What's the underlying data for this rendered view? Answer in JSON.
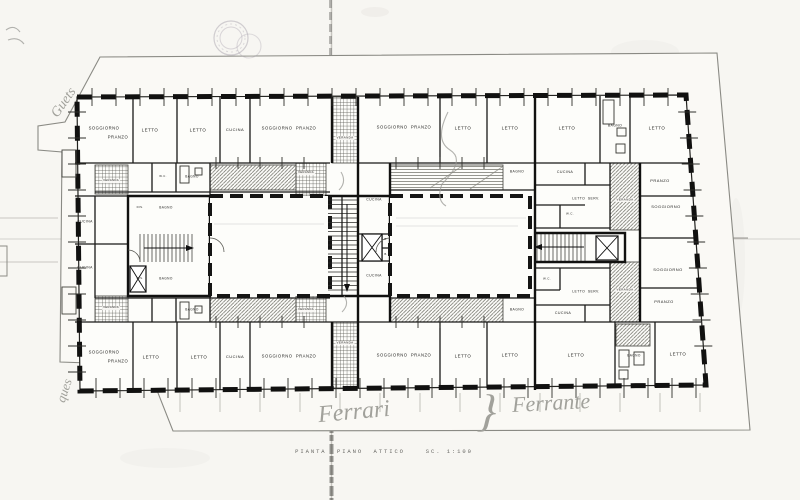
{
  "sheet": {
    "caption": "PIANTA  PIANO  ATTICO    SC. 1:100",
    "paper_color": "#f7f6f2",
    "ink_color": "#1b1b19",
    "pencil_color": "#a1a19b",
    "stamp_color": "#aaa3ae"
  },
  "rooms": [
    {
      "label": "SOGGIORNO",
      "x": 104,
      "y": 128,
      "fs": 4.2
    },
    {
      "label": "PRANZO",
      "x": 118,
      "y": 137,
      "fs": 4.2
    },
    {
      "label": "LETTO",
      "x": 150,
      "y": 130
    },
    {
      "label": "LETTO",
      "x": 198,
      "y": 130
    },
    {
      "label": "CUCINA",
      "x": 235,
      "y": 130,
      "fs": 4
    },
    {
      "label": "SOGGIORNO  PRANZO",
      "x": 289,
      "y": 128,
      "fs": 4.2
    },
    {
      "label": "VERANDA",
      "x": 345,
      "y": 138,
      "fs": 3,
      "bg": true
    },
    {
      "label": "SOGGIORNO  PRANZO",
      "x": 404,
      "y": 127,
      "fs": 4.2
    },
    {
      "label": "LETTO",
      "x": 463,
      "y": 128
    },
    {
      "label": "LETTO",
      "x": 510,
      "y": 128
    },
    {
      "label": "LETTO",
      "x": 567,
      "y": 128
    },
    {
      "label": "BAGNO",
      "x": 615,
      "y": 126,
      "fs": 3.4
    },
    {
      "label": "LETTO",
      "x": 657,
      "y": 128
    },
    {
      "label": "CUCINA",
      "x": 565,
      "y": 172,
      "fs": 3.6
    },
    {
      "label": "PRANZO",
      "x": 660,
      "y": 181,
      "fs": 4
    },
    {
      "label": "LETTO  SERV.",
      "x": 586,
      "y": 199,
      "fs": 3.4
    },
    {
      "label": "VERANDA",
      "x": 625,
      "y": 200,
      "fs": 3,
      "bg": true
    },
    {
      "label": "SOGGIORNO",
      "x": 666,
      "y": 207,
      "fs": 4
    },
    {
      "label": "W.C.",
      "x": 570,
      "y": 214,
      "fs": 3
    },
    {
      "label": "CUCINA",
      "x": 85,
      "y": 222,
      "fs": 3.4
    },
    {
      "label": "CUCINA",
      "x": 85,
      "y": 268,
      "fs": 3.4
    },
    {
      "label": "VERANDA",
      "x": 111,
      "y": 181,
      "fs": 2.8,
      "bg": true
    },
    {
      "label": "W.C.",
      "x": 163,
      "y": 177,
      "fs": 2.8
    },
    {
      "label": "BAGNO",
      "x": 192,
      "y": 177,
      "fs": 3.2
    },
    {
      "label": "DIS.",
      "x": 140,
      "y": 208,
      "fs": 2.8
    },
    {
      "label": "BAGNO",
      "x": 166,
      "y": 208,
      "fs": 3.2
    },
    {
      "label": "DIS.",
      "x": 140,
      "y": 279,
      "fs": 2.8
    },
    {
      "label": "BAGNO",
      "x": 166,
      "y": 279,
      "fs": 3.2
    },
    {
      "label": "VERANDA",
      "x": 111,
      "y": 308,
      "fs": 2.8,
      "bg": true
    },
    {
      "label": "BAGNO",
      "x": 192,
      "y": 310,
      "fs": 3.2
    },
    {
      "label": "VERANDA",
      "x": 306,
      "y": 173,
      "fs": 2.8,
      "bg": true
    },
    {
      "label": "CUCINA",
      "x": 374,
      "y": 200,
      "fs": 3.4
    },
    {
      "label": "B.",
      "x": 386,
      "y": 240,
      "fs": 2.8
    },
    {
      "label": "B.",
      "x": 386,
      "y": 255,
      "fs": 2.8
    },
    {
      "label": "CUCINA",
      "x": 374,
      "y": 276,
      "fs": 3.4
    },
    {
      "label": "VERANDA",
      "x": 306,
      "y": 310,
      "fs": 2.8,
      "bg": true
    },
    {
      "label": "BAGNO",
      "x": 517,
      "y": 172,
      "fs": 3.4
    },
    {
      "label": "BAGNO",
      "x": 517,
      "y": 310,
      "fs": 3.4
    },
    {
      "label": "W.C.",
      "x": 547,
      "y": 279,
      "fs": 3
    },
    {
      "label": "LETTO  SERV.",
      "x": 586,
      "y": 292,
      "fs": 3.4
    },
    {
      "label": "VERANDA",
      "x": 625,
      "y": 290,
      "fs": 3,
      "bg": true
    },
    {
      "label": "SOGGIORNO",
      "x": 668,
      "y": 270,
      "fs": 4
    },
    {
      "label": "PRANZO",
      "x": 664,
      "y": 302,
      "fs": 4
    },
    {
      "label": "CUCINA",
      "x": 563,
      "y": 313,
      "fs": 3.6
    },
    {
      "label": "SOGGIORNO",
      "x": 104,
      "y": 352,
      "fs": 4.2
    },
    {
      "label": "PRANZO",
      "x": 118,
      "y": 361,
      "fs": 4.2
    },
    {
      "label": "LETTO",
      "x": 151,
      "y": 357
    },
    {
      "label": "LETTO",
      "x": 199,
      "y": 357
    },
    {
      "label": "CUCINA",
      "x": 235,
      "y": 357,
      "fs": 4
    },
    {
      "label": "SOGGIORNO  PRANZO",
      "x": 289,
      "y": 356,
      "fs": 4.2
    },
    {
      "label": "VERANDA",
      "x": 345,
      "y": 343,
      "fs": 3,
      "bg": true
    },
    {
      "label": "SOGGIORNO  PRANZO",
      "x": 404,
      "y": 355,
      "fs": 4.2
    },
    {
      "label": "LETTO",
      "x": 463,
      "y": 356
    },
    {
      "label": "LETTO",
      "x": 510,
      "y": 355
    },
    {
      "label": "LETTO",
      "x": 576,
      "y": 355
    },
    {
      "label": "BAGNO",
      "x": 634,
      "y": 356,
      "fs": 3.2
    },
    {
      "label": "LETTO",
      "x": 678,
      "y": 354
    }
  ],
  "annotations": {
    "handwriting": [
      {
        "text": "Guets",
        "x": 48,
        "y": 96,
        "rot": -55,
        "fs": 14
      },
      {
        "text": "ques",
        "x": 52,
        "y": 384,
        "rot": -72,
        "fs": 13
      },
      {
        "text": "Ferrari",
        "x": 318,
        "y": 400,
        "rot": -5,
        "fs": 24
      },
      {
        "text": "}",
        "x": 478,
        "y": 388,
        "rot": 4,
        "fs": 46
      },
      {
        "text": "Ferrante",
        "x": 512,
        "y": 392,
        "rot": -3,
        "fs": 22
      }
    ]
  }
}
